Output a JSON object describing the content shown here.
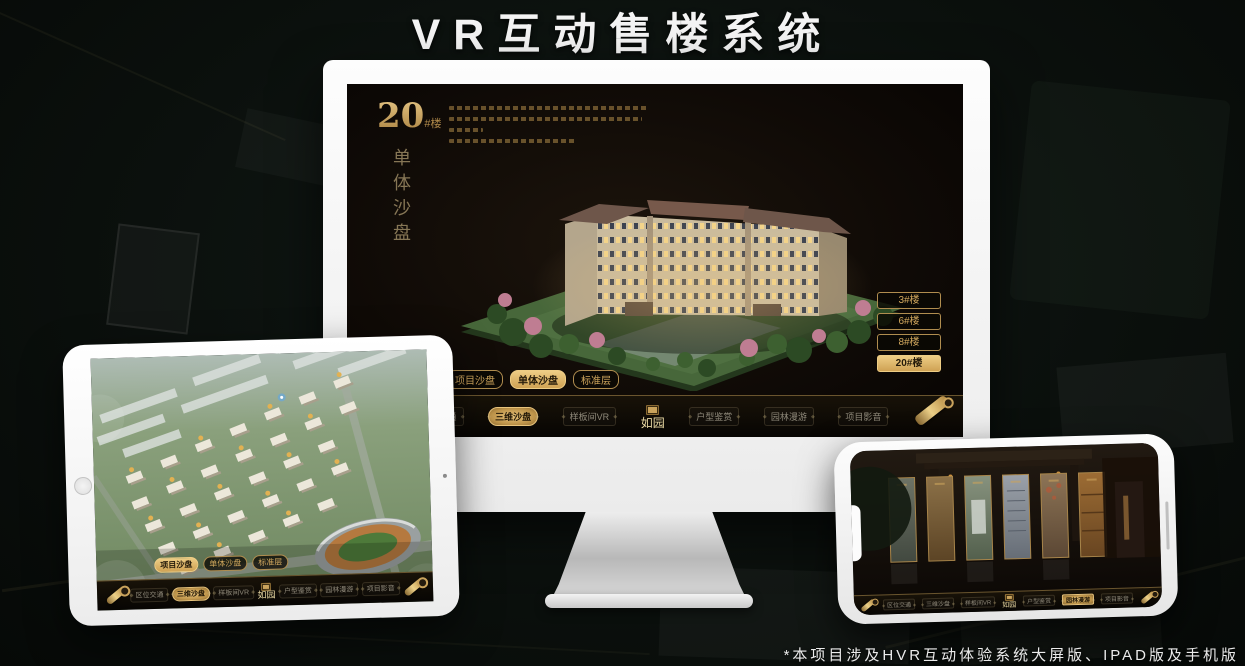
{
  "title": "VR互动售楼系统",
  "footnote": "*本项目涉及HVR互动体验系统大屏版、IPAD版及手机版",
  "colors": {
    "gold_accent": "#d2a85e",
    "gold_fill": "#eecd85",
    "screen_background": "#0f0a06",
    "title_text": "#f4f4f4"
  },
  "logo_text": "如园",
  "nav_items": [
    "区位交通",
    "三维沙盘",
    "样板间VR",
    "户型鉴赏",
    "园林漫游",
    "项目影音"
  ],
  "monitor": {
    "headline_number": "20",
    "headline_suffix": "#楼",
    "headline_subtitle": "单体沙盘",
    "floor_buttons": [
      "3#楼",
      "6#楼",
      "8#楼",
      "20#楼"
    ],
    "selected_floor": "20#楼",
    "view_tabs": [
      "项目沙盘",
      "单体沙盘",
      "标准层"
    ],
    "selected_view_tab": "单体沙盘",
    "selected_nav_item": "三维沙盘"
  },
  "tablet": {
    "view_tabs": [
      "项目沙盘",
      "单体沙盘",
      "标准层"
    ],
    "selected_view_tab": "项目沙盘",
    "selected_nav_item": "三维沙盘"
  },
  "phone": {
    "selected_nav_item": "园林漫游"
  }
}
